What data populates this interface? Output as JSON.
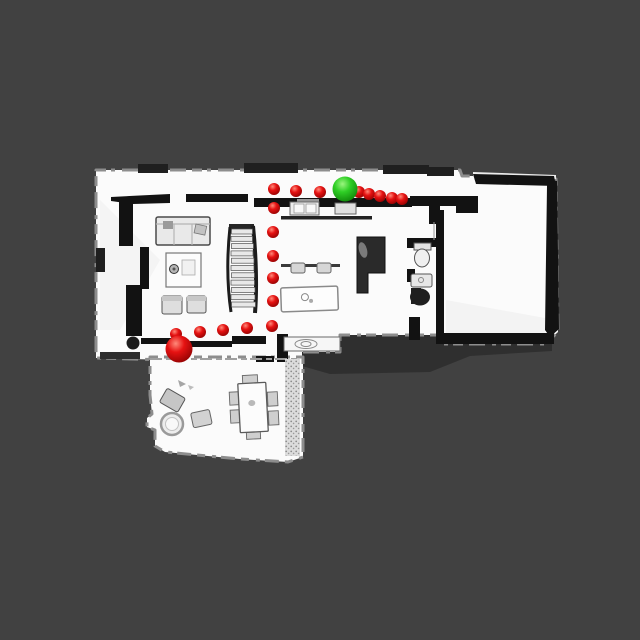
{
  "scene": {
    "kind": "top-down-floorplan-scan-with-navigation-markers",
    "background_color": "#414141"
  },
  "palette": {
    "floor": "#fbfbfb",
    "wall": "#121212",
    "furniture_fill": "#e6e6e6",
    "shadow": "#2f2f2f",
    "red_highlight": "#ff8a7a",
    "red_mid": "#e61212",
    "red_dark": "#8a0000",
    "green_highlight": "#9bf57f",
    "green_mid": "#2fcf26",
    "green_dark": "#0c7d06"
  },
  "markers": {
    "start": {
      "x": 179,
      "y": 349,
      "r": 13.5
    },
    "goal": {
      "x": 345,
      "y": 189,
      "r": 12.5
    },
    "waypoints": [
      {
        "x": 176,
        "y": 334,
        "r": 6
      },
      {
        "x": 200,
        "y": 332,
        "r": 6
      },
      {
        "x": 223,
        "y": 330,
        "r": 6
      },
      {
        "x": 247,
        "y": 328,
        "r": 6
      },
      {
        "x": 272,
        "y": 326,
        "r": 6
      },
      {
        "x": 273,
        "y": 301,
        "r": 6
      },
      {
        "x": 273,
        "y": 278,
        "r": 6
      },
      {
        "x": 273,
        "y": 256,
        "r": 6
      },
      {
        "x": 273,
        "y": 232,
        "r": 6
      },
      {
        "x": 274,
        "y": 208,
        "r": 6
      },
      {
        "x": 274,
        "y": 189,
        "r": 6
      },
      {
        "x": 296,
        "y": 191,
        "r": 6
      },
      {
        "x": 320,
        "y": 192,
        "r": 6
      },
      {
        "x": 359,
        "y": 192,
        "r": 6
      },
      {
        "x": 369,
        "y": 194,
        "r": 6
      },
      {
        "x": 380,
        "y": 196,
        "r": 6
      },
      {
        "x": 392,
        "y": 198,
        "r": 6
      },
      {
        "x": 402,
        "y": 199,
        "r": 6
      }
    ]
  }
}
